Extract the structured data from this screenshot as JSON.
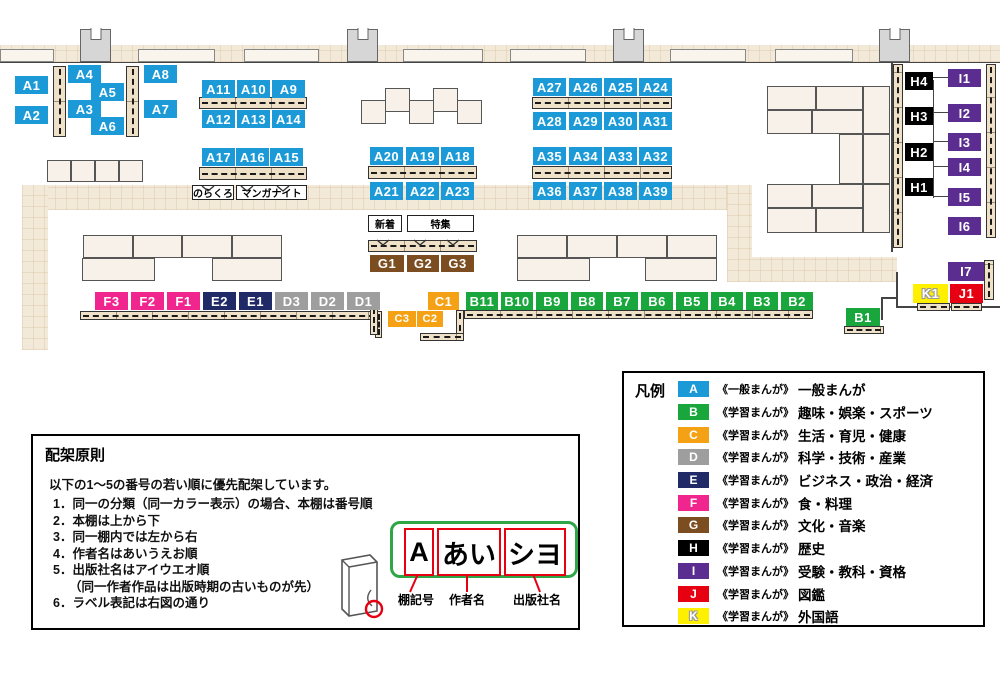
{
  "map": {
    "sections": {
      "A": [
        "A1",
        "A2",
        "A3",
        "A4",
        "A5",
        "A6",
        "A7",
        "A8",
        "A9",
        "A10",
        "A11",
        "A12",
        "A13",
        "A14",
        "A15",
        "A16",
        "A17",
        "A18",
        "A19",
        "A20",
        "A21",
        "A22",
        "A23",
        "A24",
        "A25",
        "A26",
        "A27",
        "A28",
        "A29",
        "A30",
        "A31",
        "A32",
        "A33",
        "A34",
        "A35",
        "A36",
        "A37",
        "A38",
        "A39"
      ],
      "B": [
        "B1",
        "B2",
        "B3",
        "B4",
        "B5",
        "B6",
        "B7",
        "B8",
        "B9",
        "B10",
        "B11"
      ],
      "C": [
        "C1",
        "C2",
        "C3"
      ],
      "D": [
        "D1",
        "D2",
        "D3"
      ],
      "E": [
        "E1",
        "E2"
      ],
      "F": [
        "F1",
        "F2",
        "F3"
      ],
      "G": [
        "G1",
        "G2",
        "G3"
      ],
      "H": [
        "H1",
        "H2",
        "H3",
        "H4"
      ],
      "I": [
        "I1",
        "I2",
        "I3",
        "I4",
        "I5",
        "I6",
        "I7"
      ],
      "J": [
        "J1"
      ],
      "K": [
        "K1"
      ]
    },
    "annotations": {
      "norakuro": "のらくろ",
      "manga_night": "マンガナイト",
      "new_arrivals": "新着",
      "feature": "特集"
    }
  },
  "legend": {
    "title": "凡例",
    "items": [
      {
        "code": "A",
        "color": "#1B9AD7",
        "type": "《一般まんが》",
        "category": "一般まんが"
      },
      {
        "code": "B",
        "color": "#19A63D",
        "type": "《学習まんが》",
        "category": "趣味・娯楽・スポーツ"
      },
      {
        "code": "C",
        "color": "#F5A115",
        "type": "《学習まんが》",
        "category": "生活・育児・健康"
      },
      {
        "code": "D",
        "color": "#9E9E9F",
        "type": "《学習まんが》",
        "category": "科学・技術・産業"
      },
      {
        "code": "E",
        "color": "#1F2A67",
        "type": "《学習まんが》",
        "category": "ビジネス・政治・経済"
      },
      {
        "code": "F",
        "color": "#F0258D",
        "type": "《学習まんが》",
        "category": "食・料理"
      },
      {
        "code": "G",
        "color": "#7B4D20",
        "type": "《学習まんが》",
        "category": "文化・音楽"
      },
      {
        "code": "H",
        "color": "#000000",
        "type": "《学習まんが》",
        "category": "歴史"
      },
      {
        "code": "I",
        "color": "#5C2D90",
        "type": "《学習まんが》",
        "category": "受験・教科・資格"
      },
      {
        "code": "J",
        "color": "#E60012",
        "type": "《学習まんが》",
        "category": "図鑑"
      },
      {
        "code": "K",
        "color": "#FFF000",
        "type": "《学習まんが》",
        "category": "外国語"
      }
    ]
  },
  "principles": {
    "title": "配架原則",
    "intro": "以下の1～5の番号の若い順に優先配架しています。",
    "items": [
      "1．同一の分類（同一カラー表示）の場合、本棚は番号順",
      "2．本棚は上から下",
      "3．同一棚内では左から右",
      "4．作者名はあいうえお順",
      "5．出版社名はアイウエオ順",
      "（同一作者作品は出版時期の古いものが先）",
      "6．ラベル表記は右図の通り"
    ],
    "label_example": {
      "shelf_code": "A",
      "author": "あい",
      "publisher": "シヨ"
    },
    "callouts": [
      "棚記号",
      "作者名",
      "出版社名"
    ]
  }
}
